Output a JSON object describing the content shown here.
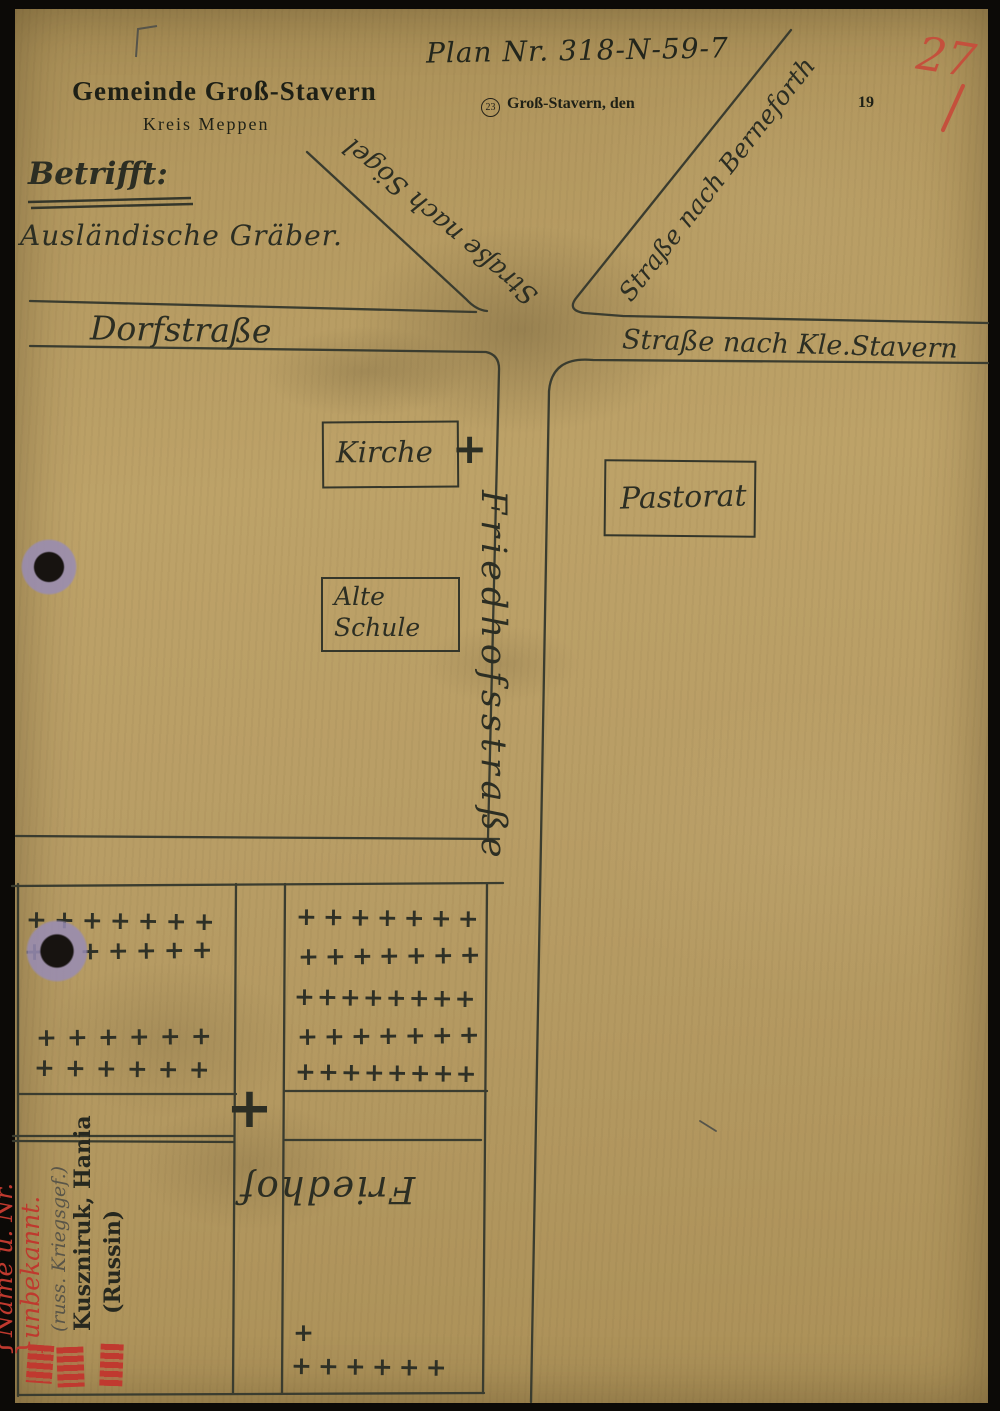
{
  "letterhead": {
    "municipality": "Gemeinde Groß-Stavern",
    "district": "Kreis Meppen"
  },
  "header": {
    "plan_number": "Plan Nr. 318-N-59-7",
    "postal_code": "23",
    "dateline": "Groß-Stavern, den",
    "year_prefix": "19",
    "red_number": "27"
  },
  "subject": {
    "label": "Betrifft:",
    "text": "Ausländische Gräber."
  },
  "streets": {
    "dorfstrasse": "Dorfstraße",
    "nach_kle_stavern": "Straße nach Kle.Stavern",
    "nach_soegel": "Straße nach Sögel",
    "nach_berneforth": "Straße nach Berneforth",
    "friedhofstrasse": "Friedhofsstraße"
  },
  "buildings": {
    "kirche": "Kirche",
    "pastorat": "Pastorat",
    "alte_schule_line1": "Alte",
    "alte_schule_line2": "Schule"
  },
  "cemetery": {
    "label": "Friedhof",
    "church_cross": "+",
    "path_cross": "+",
    "upper_left_rows": [
      "+++++++",
      "+++++++",
      "++++++",
      "++++++"
    ],
    "upper_right_rows": [
      "+++++++",
      "+++++++",
      "++++++++",
      "+++++++",
      "++++++++"
    ],
    "lower_right_single": "+",
    "lower_right_row": "++++++"
  },
  "grave_annotations": {
    "red_line1": "Name u. Nr.",
    "red_line2": "unbekannt.",
    "brace": "}",
    "pencil_note": "(russ. Kriegsgef.)",
    "name": "Kuszniruk, Hania",
    "nationality": "(Russin)"
  },
  "colors": {
    "paper": "#b69b64",
    "ink": "#33352a",
    "red": "#bf392e"
  }
}
